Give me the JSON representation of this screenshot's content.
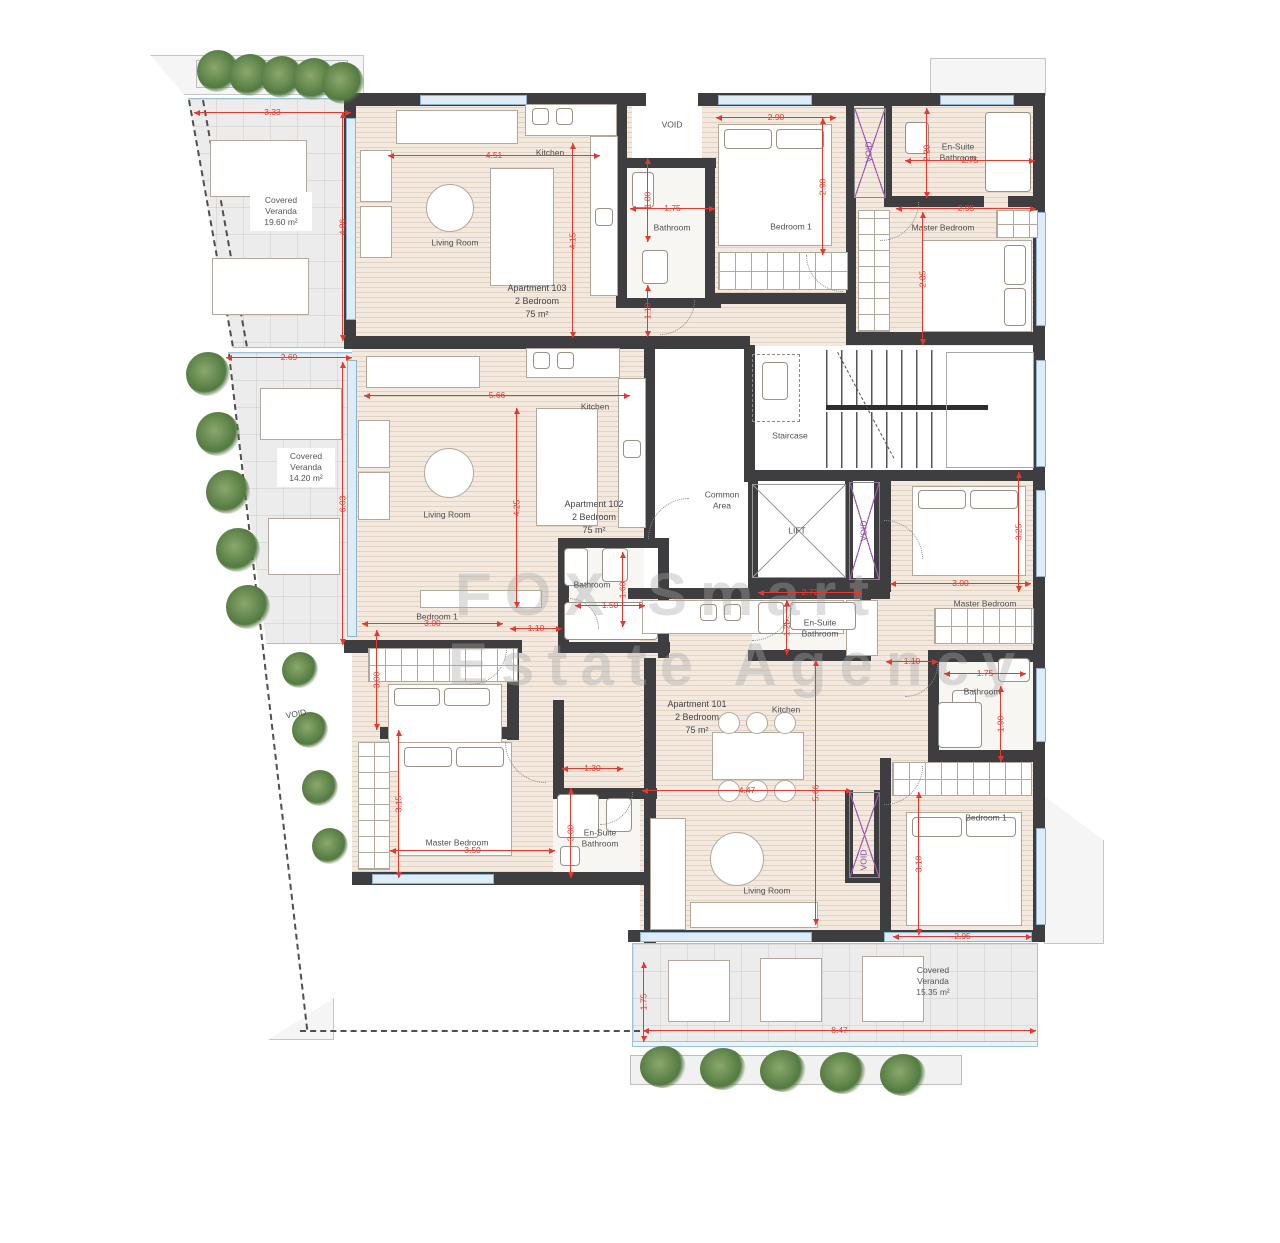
{
  "watermark": {
    "line1": "FOX Smart",
    "line2": "Estate Agency"
  },
  "apartments": [
    {
      "name": "Apartment 103",
      "type": "2 Bedroom",
      "area": "75 m²"
    },
    {
      "name": "Apartment 102",
      "type": "2 Bedroom",
      "area": "75 m²"
    },
    {
      "name": "Apartment 101",
      "type": "2 Bedroom",
      "area": "75 m²"
    }
  ],
  "verandas": [
    {
      "name": "Covered Veranda",
      "area": "19.60 m²"
    },
    {
      "name": "Covered Veranda",
      "area": "14.20 m²"
    },
    {
      "name": "Covered Veranda",
      "area": "15.35 m²"
    }
  ],
  "rooms": [
    "Living Room",
    "Kitchen",
    "Bathroom",
    "Bedroom 1",
    "En-Suite Bathroom",
    "Master Bedroom",
    "VOID",
    "VOID",
    "Living Room",
    "Kitchen",
    "Bathroom",
    "Bedroom 1",
    "Master Bedroom",
    "En-Suite Bathroom",
    "Staircase",
    "Common Area",
    "LIFT",
    "VOID",
    "VOID",
    "Kitchen",
    "Living Room",
    "En-Suite Bathroom",
    "Master Bedroom",
    "Bathroom",
    "Bedroom 1",
    "VOID"
  ],
  "dims": [
    "3.33",
    "4.86",
    "4.51",
    "4.15",
    "1.80",
    "1.75",
    "1.10",
    "2.90",
    "2.90",
    "2.20",
    "2.75",
    "2.95",
    "2.85",
    "2.69",
    "5.66",
    "4.25",
    "6.03",
    "1.60",
    "1.50",
    "3.00",
    "3.00",
    "1.10",
    "3.15",
    "3.50",
    "1.30",
    "3.00",
    "2.72",
    "1.25",
    "1.10",
    "3.00",
    "3.25",
    "1.75",
    "1.90",
    "4.47",
    "5.66",
    "3.10",
    "2.95",
    "1.75",
    "8.47"
  ]
}
